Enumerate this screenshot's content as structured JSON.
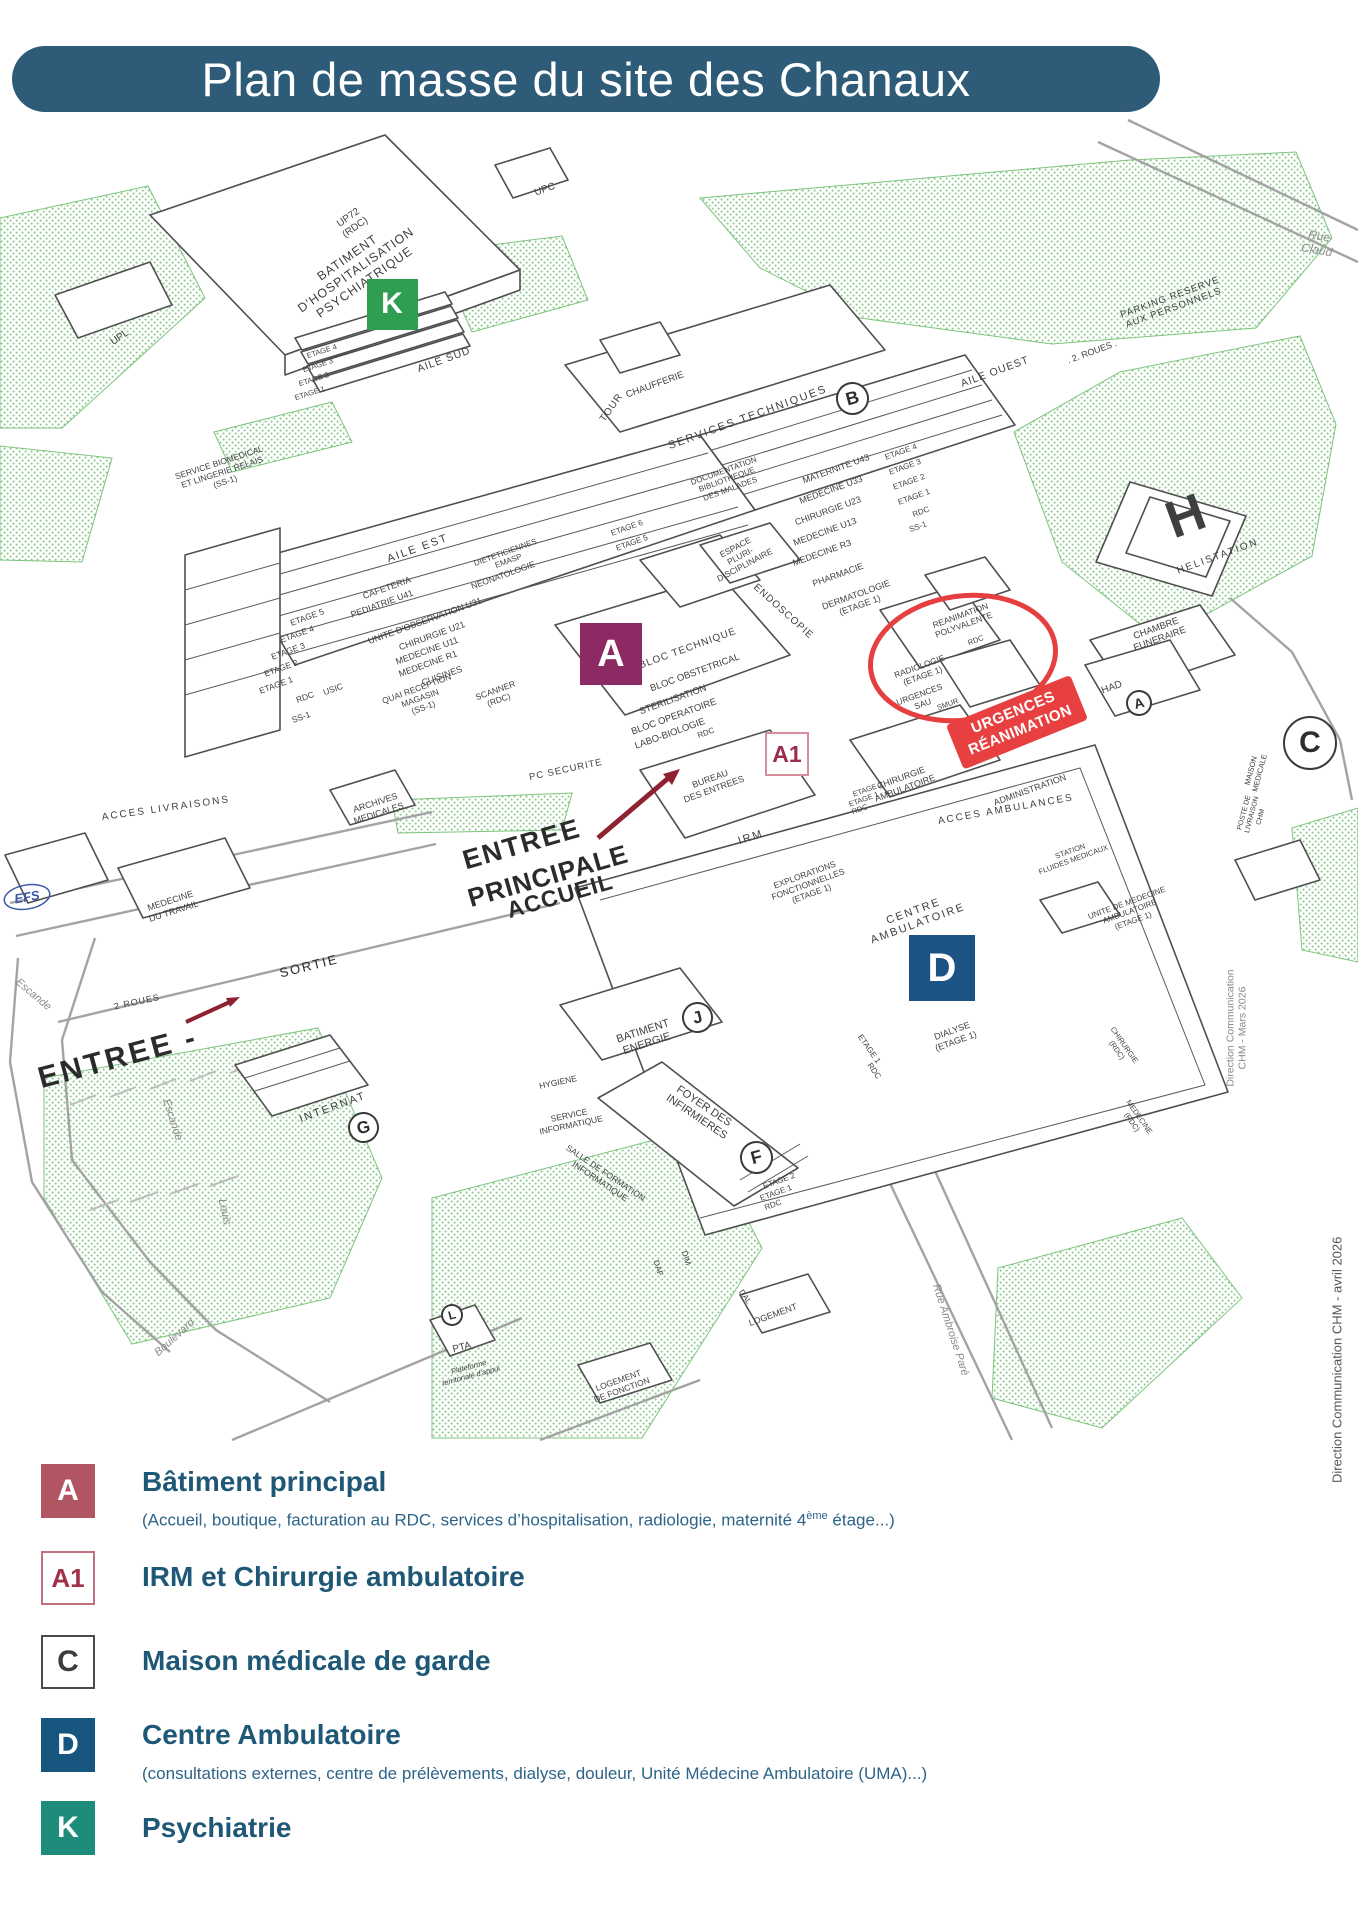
{
  "header": {
    "title": "Plan de masse du site des Chanaux",
    "bg": "#2e5b77"
  },
  "credits": {
    "page_credit": "Direction Communication CHM - avril 2026",
    "map_credit": "Direction Communication CHM - Mars 2026"
  },
  "map": {
    "accent_red": "#e63f3f",
    "arrow_red": "#8e2230",
    "badge": {
      "lines": "URGENCES\nRÉANIMATION",
      "x": 1017,
      "y": 722,
      "r": -22,
      "bg": "#e84040"
    },
    "markers": [
      {
        "shape": "square",
        "label": "K",
        "x": 392,
        "y": 304,
        "size": 51,
        "bg": "#2f9e51",
        "color": "#ffffff",
        "fs": 30
      },
      {
        "shape": "square",
        "label": "A",
        "x": 611,
        "y": 654,
        "size": 62,
        "bg": "#8e2a63",
        "color": "#ffffff",
        "fs": 38
      },
      {
        "shape": "square",
        "label": "A1",
        "x": 787,
        "y": 754,
        "size": 44,
        "bg": "#ffffff",
        "color": "#9c2d4a",
        "border": "#d4919c",
        "fs": 23
      },
      {
        "shape": "square",
        "label": "D",
        "x": 942,
        "y": 968,
        "size": 66,
        "bg": "#1d5285",
        "color": "#ffffff",
        "fs": 40
      },
      {
        "shape": "circle",
        "label": "B",
        "x": 852,
        "y": 398,
        "size": 33,
        "fs": 18,
        "r": -15
      },
      {
        "shape": "circle",
        "label": "J",
        "x": 697,
        "y": 1017,
        "size": 31,
        "fs": 17,
        "r": -15
      },
      {
        "shape": "circle",
        "label": "F",
        "x": 756,
        "y": 1157,
        "size": 33,
        "fs": 18,
        "r": -15
      },
      {
        "shape": "circle",
        "label": "G",
        "x": 363,
        "y": 1127,
        "size": 31,
        "fs": 17,
        "r": -15
      },
      {
        "shape": "circle",
        "label": "A",
        "x": 1139,
        "y": 703,
        "size": 26,
        "fs": 14,
        "r": -15
      },
      {
        "shape": "circle",
        "label": "L",
        "x": 452,
        "y": 1315,
        "size": 22,
        "fs": 12,
        "r": -15
      },
      {
        "shape": "circle",
        "label": "C",
        "x": 1310,
        "y": 743,
        "size": 54,
        "fs": 30,
        "r": 0
      }
    ],
    "labels": [
      {
        "t": "UPC",
        "x": 545,
        "y": 190,
        "r": -20,
        "s": 10
      },
      {
        "t": "UP72\n(RDC)",
        "x": 352,
        "y": 223,
        "r": -35,
        "s": 10
      },
      {
        "t": "UPL",
        "x": 120,
        "y": 338,
        "r": -35,
        "s": 10
      },
      {
        "t": "BATIMENT\nD'HOSPITALISATION\nPSYCHIATRIQUE",
        "x": 356,
        "y": 270,
        "r": -35,
        "s": 12.5,
        "ls": 1
      },
      {
        "t": "Rue Claud",
        "x": 1318,
        "y": 243,
        "r": 10,
        "s": 12,
        "c": "#8a8a8a",
        "i": 1
      },
      {
        "t": "PARKING RESERVE\nAUX PERSONNELS",
        "x": 1172,
        "y": 303,
        "r": -20,
        "s": 9.5,
        "ls": 1
      },
      {
        "t": ". 2. ROUES .",
        "x": 1092,
        "y": 352,
        "r": -20,
        "s": 9
      },
      {
        "t": "CHAUFFERIE",
        "x": 655,
        "y": 385,
        "r": -20,
        "s": 9.5
      },
      {
        "t": "SERVICES TECHNIQUES",
        "x": 748,
        "y": 418,
        "r": -20,
        "s": 11,
        "ls": 2
      },
      {
        "t": "AILE OUEST",
        "x": 995,
        "y": 372,
        "r": -20,
        "s": 10.5,
        "ls": 1
      },
      {
        "t": "AILE SUD",
        "x": 444,
        "y": 360,
        "r": -20,
        "s": 10.5,
        "ls": 1
      },
      {
        "t": "TOUR",
        "x": 612,
        "y": 408,
        "r": -55,
        "s": 10,
        "ls": 1
      },
      {
        "t": "ETAGE 4",
        "x": 322,
        "y": 352,
        "r": -18,
        "s": 7.5
      },
      {
        "t": "ETAGE 3",
        "x": 318,
        "y": 366,
        "r": -18,
        "s": 7.5
      },
      {
        "t": "ETAGE 2",
        "x": 314,
        "y": 380,
        "r": -18,
        "s": 7.5
      },
      {
        "t": "ETAGE 1",
        "x": 310,
        "y": 394,
        "r": -18,
        "s": 7.5
      },
      {
        "t": "SERVICE BIOMEDICAL\nET LINGERIE RELAIS\n(SS-1)",
        "x": 222,
        "y": 472,
        "r": -18,
        "s": 8.5
      },
      {
        "t": "DOCUMENTATION\nBIBLIOTHEQUE\nDES MALADES",
        "x": 727,
        "y": 480,
        "r": -20,
        "s": 8
      },
      {
        "t": "MATERNITE U43",
        "x": 836,
        "y": 469,
        "r": -20,
        "s": 9
      },
      {
        "t": "MEDECINE U33",
        "x": 831,
        "y": 490,
        "r": -20,
        "s": 9
      },
      {
        "t": "CHIRURGIE U23",
        "x": 828,
        "y": 511,
        "r": -20,
        "s": 9
      },
      {
        "t": "MEDECINE U13",
        "x": 825,
        "y": 532,
        "r": -20,
        "s": 9
      },
      {
        "t": "MEDECINE R3",
        "x": 822,
        "y": 553,
        "r": -20,
        "s": 9
      },
      {
        "t": "PHARMACIE",
        "x": 838,
        "y": 575,
        "r": -20,
        "s": 9
      },
      {
        "t": "DERMATOLOGIE\n(ETAGE 1)",
        "x": 858,
        "y": 600,
        "r": -20,
        "s": 9
      },
      {
        "t": "ETAGE 4",
        "x": 901,
        "y": 452,
        "r": -20,
        "s": 8
      },
      {
        "t": "ETAGE 3",
        "x": 905,
        "y": 467,
        "r": -20,
        "s": 8
      },
      {
        "t": "ETAGE 2",
        "x": 909,
        "y": 482,
        "r": -20,
        "s": 8
      },
      {
        "t": "ETAGE 1",
        "x": 914,
        "y": 497,
        "r": -20,
        "s": 8
      },
      {
        "t": "RDC",
        "x": 921,
        "y": 512,
        "r": -20,
        "s": 8
      },
      {
        "t": "SS-1",
        "x": 918,
        "y": 527,
        "r": -20,
        "s": 8
      },
      {
        "t": "ESPACE\nPLURI-\nDISCIPLINAIRE",
        "x": 740,
        "y": 556,
        "r": -28,
        "s": 8.5
      },
      {
        "t": "ENDOSCOPIE",
        "x": 783,
        "y": 612,
        "r": 42,
        "s": 10,
        "ls": 1
      },
      {
        "t": "AILE EST",
        "x": 418,
        "y": 549,
        "r": -20,
        "s": 11,
        "ls": 2
      },
      {
        "t": "ETAGE 5",
        "x": 307,
        "y": 617,
        "r": -20,
        "s": 8.5
      },
      {
        "t": "ETAGE 4",
        "x": 297,
        "y": 634,
        "r": -20,
        "s": 8.5
      },
      {
        "t": "ETAGE 3",
        "x": 288,
        "y": 651,
        "r": -20,
        "s": 8.5
      },
      {
        "t": "ETAGE 2",
        "x": 281,
        "y": 668,
        "r": -20,
        "s": 8.5
      },
      {
        "t": "ETAGE 1",
        "x": 276,
        "y": 685,
        "r": -20,
        "s": 8.5
      },
      {
        "t": "RDC",
        "x": 305,
        "y": 697,
        "r": -20,
        "s": 8.5
      },
      {
        "t": "USIC",
        "x": 333,
        "y": 689,
        "r": -20,
        "s": 8.5
      },
      {
        "t": "SS-1",
        "x": 301,
        "y": 717,
        "r": -20,
        "s": 8.5
      },
      {
        "t": "CAFETERIA",
        "x": 387,
        "y": 588,
        "r": -20,
        "s": 9
      },
      {
        "t": "PEDIATRIE U41",
        "x": 382,
        "y": 604,
        "r": -20,
        "s": 9
      },
      {
        "t": "UNITE D'OBSERVATION U31",
        "x": 425,
        "y": 621,
        "r": -20,
        "s": 9
      },
      {
        "t": "CHIRURGIE U21",
        "x": 432,
        "y": 636,
        "r": -20,
        "s": 9
      },
      {
        "t": "MEDECINE U11",
        "x": 427,
        "y": 651,
        "r": -20,
        "s": 9
      },
      {
        "t": "MEDECINE R1",
        "x": 428,
        "y": 664,
        "r": -20,
        "s": 9
      },
      {
        "t": "CUISINES",
        "x": 442,
        "y": 676,
        "r": -20,
        "s": 9
      },
      {
        "t": "DIETETICIENNES\nEMASP",
        "x": 507,
        "y": 557,
        "r": -20,
        "s": 8
      },
      {
        "t": "NEONATOLOGIE",
        "x": 503,
        "y": 575,
        "r": -20,
        "s": 8.5
      },
      {
        "t": "QUAI RECEPTION\nMAGASIN\n(SS-1)",
        "x": 420,
        "y": 698,
        "r": -20,
        "s": 8.5
      },
      {
        "t": "SCANNER\n(RDC)",
        "x": 497,
        "y": 695,
        "r": -20,
        "s": 8.5
      },
      {
        "t": "ETAGE 6",
        "x": 627,
        "y": 528,
        "r": -20,
        "s": 8
      },
      {
        "t": "ETAGE 5",
        "x": 632,
        "y": 543,
        "r": -20,
        "s": 8
      },
      {
        "t": "BLOC TECHNIQUE",
        "x": 688,
        "y": 649,
        "r": -20,
        "s": 10,
        "ls": 1
      },
      {
        "t": "BLOC OBSTETRICAL",
        "x": 695,
        "y": 673,
        "r": -20,
        "s": 9.5
      },
      {
        "t": "STERILISATION",
        "x": 673,
        "y": 700,
        "r": -20,
        "s": 9.5
      },
      {
        "t": "BLOC OPERATOIRE",
        "x": 674,
        "y": 717,
        "r": -20,
        "s": 9.5
      },
      {
        "t": "LABO-BIOLOGIE",
        "x": 670,
        "y": 734,
        "r": -20,
        "s": 9.5
      },
      {
        "t": "RDC",
        "x": 706,
        "y": 733,
        "r": -20,
        "s": 8
      },
      {
        "t": "PC SECURITE",
        "x": 566,
        "y": 770,
        "r": -12,
        "s": 9.5,
        "ls": 1
      },
      {
        "t": "BUREAU\nDES ENTREES",
        "x": 712,
        "y": 784,
        "r": -20,
        "s": 9
      },
      {
        "t": "REANIMATION\nPOLYVALENTE",
        "x": 962,
        "y": 620,
        "r": -20,
        "s": 8.5
      },
      {
        "t": "RDC",
        "x": 976,
        "y": 641,
        "r": -20,
        "s": 7.5
      },
      {
        "t": "RADIOLOGIE\n(ETAGE 1)",
        "x": 921,
        "y": 671,
        "r": -20,
        "s": 8.5
      },
      {
        "t": "URGENCES\nSAU",
        "x": 921,
        "y": 699,
        "r": -20,
        "s": 8.5
      },
      {
        "t": "SMUR",
        "x": 948,
        "y": 705,
        "r": -20,
        "s": 7.5
      },
      {
        "t": "HAD",
        "x": 1112,
        "y": 688,
        "r": -20,
        "s": 10
      },
      {
        "t": "CHAMBRE\nFUNERAIRE",
        "x": 1158,
        "y": 634,
        "r": -20,
        "s": 9.5
      },
      {
        "t": "H",
        "x": 1186,
        "y": 517,
        "r": -20,
        "s": 52,
        "b": 1
      },
      {
        "t": "HELISTATION",
        "x": 1218,
        "y": 557,
        "r": -20,
        "s": 10,
        "ls": 2
      },
      {
        "t": "MAISON\nMEDICALE",
        "x": 1256,
        "y": 772,
        "r": -75,
        "s": 7.5
      },
      {
        "t": "POSTE DE\nLIVRAISON\nCHM",
        "x": 1253,
        "y": 815,
        "r": -75,
        "s": 7
      },
      {
        "t": "ADMINISTRATION",
        "x": 1030,
        "y": 790,
        "r": -20,
        "s": 9
      },
      {
        "t": "ACCES AMBULANCES",
        "x": 1006,
        "y": 810,
        "r": -10,
        "s": 10,
        "ls": 2
      },
      {
        "t": "CHIRURGIE\nAMBULATOIRE",
        "x": 903,
        "y": 783,
        "r": -20,
        "s": 9
      },
      {
        "t": "ETAGE 2",
        "x": 868,
        "y": 790,
        "r": -20,
        "s": 7.5
      },
      {
        "t": "ETAGE 1",
        "x": 864,
        "y": 800,
        "r": -20,
        "s": 7.5
      },
      {
        "t": "RDC",
        "x": 860,
        "y": 810,
        "r": -20,
        "s": 7.5
      },
      {
        "t": "IRM",
        "x": 751,
        "y": 838,
        "r": -18,
        "s": 11,
        "ls": 2
      },
      {
        "t": "STATION\nFLUIDES MEDICAUX",
        "x": 1072,
        "y": 856,
        "r": -20,
        "s": 7.5
      },
      {
        "t": "UNITE DE MEDECINE\nAMBULATOIRE\n(ETAGE 1)",
        "x": 1130,
        "y": 912,
        "r": -20,
        "s": 8
      },
      {
        "t": "EXPLORATIONS\nFONCTIONNELLES\n(ETAGE 1)",
        "x": 808,
        "y": 884,
        "r": -20,
        "s": 8.5
      },
      {
        "t": "CENTRE\nAMBULATOIRE",
        "x": 916,
        "y": 918,
        "r": -20,
        "s": 11,
        "ls": 2
      },
      {
        "t": "DIALYSE\n(ETAGE 1)",
        "x": 954,
        "y": 1036,
        "r": -20,
        "s": 9
      },
      {
        "t": "ETAGE 1",
        "x": 869,
        "y": 1049,
        "r": 55,
        "s": 8
      },
      {
        "t": "RDC",
        "x": 874,
        "y": 1071,
        "r": 55,
        "s": 8
      },
      {
        "t": "CHIRURGIE\n(RDC)",
        "x": 1120,
        "y": 1048,
        "r": 55,
        "s": 7.5
      },
      {
        "t": "MEDECINE\n(RDC)",
        "x": 1135,
        "y": 1120,
        "r": 55,
        "s": 7.5
      },
      {
        "t": "ACCES LIVRAISONS",
        "x": 166,
        "y": 809,
        "r": -8,
        "s": 10,
        "ls": 2
      },
      {
        "t": "ARCHIVES\nMEDICALES",
        "x": 377,
        "y": 808,
        "r": -18,
        "s": 9
      },
      {
        "t": "EFS",
        "x": 27,
        "y": 897,
        "r": -10,
        "s": 13,
        "b": 1,
        "i": 1,
        "c": "#3a57a8"
      },
      {
        "t": "MEDECINE\nDU TRAVAIL",
        "x": 172,
        "y": 906,
        "r": -18,
        "s": 9
      },
      {
        "t": "ENTREE",
        "x": 522,
        "y": 845,
        "r": -16,
        "s": 27,
        "b": 1,
        "c": "#2b2b2b",
        "ls": 2
      },
      {
        "t": "PRINCIPALE",
        "x": 548,
        "y": 876,
        "r": -16,
        "s": 26,
        "b": 1,
        "c": "#2b2b2b",
        "ls": 1
      },
      {
        "t": "ACCUEIL",
        "x": 560,
        "y": 896,
        "r": -16,
        "s": 23,
        "b": 1,
        "c": "#2b2b2b",
        "ls": 1
      },
      {
        "t": "SORTIE",
        "x": 309,
        "y": 966,
        "r": -14,
        "s": 13,
        "ls": 2,
        "c": "#2b2b2b"
      },
      {
        "t": "2 ROUES",
        "x": 137,
        "y": 1002,
        "r": -12,
        "s": 9,
        "ls": 1
      },
      {
        "t": "ENTREE -",
        "x": 118,
        "y": 1058,
        "r": -15,
        "s": 30,
        "b": 1,
        "c": "#2b2b2b",
        "ls": 3
      },
      {
        "t": "Escande",
        "x": 33,
        "y": 995,
        "r": 40,
        "s": 11,
        "c": "#8a8a8a",
        "i": 1
      },
      {
        "t": "Escande",
        "x": 172,
        "y": 1120,
        "r": 72,
        "s": 11,
        "c": "#8a8a8a",
        "i": 1
      },
      {
        "t": "Louis",
        "x": 224,
        "y": 1212,
        "r": 78,
        "s": 11,
        "c": "#8a8a8a",
        "i": 1
      },
      {
        "t": "Boulevard",
        "x": 175,
        "y": 1338,
        "r": -42,
        "s": 11,
        "c": "#8a8a8a",
        "i": 1
      },
      {
        "t": "INTERNAT",
        "x": 333,
        "y": 1108,
        "r": -20,
        "s": 11,
        "ls": 2
      },
      {
        "t": "BATIMENT\nENERGIE",
        "x": 645,
        "y": 1038,
        "r": -18,
        "s": 11
      },
      {
        "t": "FOYER DES\nINFIRMIERES",
        "x": 700,
        "y": 1112,
        "r": 34,
        "s": 11
      },
      {
        "t": "ETAGE 2",
        "x": 779,
        "y": 1181,
        "r": -20,
        "s": 8
      },
      {
        "t": "ETAGE 1",
        "x": 776,
        "y": 1193,
        "r": -20,
        "s": 8
      },
      {
        "t": "RDC",
        "x": 773,
        "y": 1205,
        "r": -20,
        "s": 8
      },
      {
        "t": "HYGIENE",
        "x": 558,
        "y": 1082,
        "r": -12,
        "s": 8.5
      },
      {
        "t": "SERVICE\nINFORMATIQUE",
        "x": 570,
        "y": 1120,
        "r": -12,
        "s": 8.5
      },
      {
        "t": "SALLE DE FORMATION\nINFORMATIQUE",
        "x": 603,
        "y": 1177,
        "r": 34,
        "s": 8.5
      },
      {
        "t": "DAF",
        "x": 658,
        "y": 1268,
        "r": 72,
        "s": 8
      },
      {
        "t": "DIM",
        "x": 686,
        "y": 1258,
        "r": 72,
        "s": 8
      },
      {
        "t": "DAL",
        "x": 745,
        "y": 1297,
        "r": 55,
        "s": 8
      },
      {
        "t": "PTA",
        "x": 462,
        "y": 1348,
        "r": -15,
        "s": 10
      },
      {
        "t": "Plateforme\nterritoriale d'appui",
        "x": 470,
        "y": 1372,
        "r": -15,
        "s": 7.5,
        "i": 1
      },
      {
        "t": "LOGEMENT",
        "x": 773,
        "y": 1315,
        "r": -20,
        "s": 9
      },
      {
        "t": "LOGEMENT\nDE FONCTION",
        "x": 620,
        "y": 1385,
        "r": -20,
        "s": 8.5
      },
      {
        "t": "Rue Ambroise Paré",
        "x": 950,
        "y": 1330,
        "r": 72,
        "s": 11,
        "c": "#8a8a8a",
        "i": 1
      },
      {
        "t": "Direction Communication CHM - Mars 2026",
        "x": 1237,
        "y": 1028,
        "r": -90,
        "s": 10.5,
        "c": "#8a8a8a"
      }
    ]
  },
  "legend": {
    "items": [
      {
        "code": "A",
        "bg": "#b25563",
        "color": "#ffffff",
        "box_top": 1464,
        "title_top": 1466,
        "title": "Bâtiment principal",
        "subtitle_top": 1510,
        "subtitle": [
          {
            "t": "(Accueil, boutique, facturation au RDC, services d’hospitalisation, radiologie, maternité 4"
          },
          {
            "t": "ème",
            "sup": true
          },
          {
            "t": " étage...)"
          }
        ]
      },
      {
        "code": "A1",
        "bg": "#ffffff",
        "color": "#a03048",
        "border": "#c4707f",
        "box_top": 1551,
        "title_top": 1561,
        "title": "IRM et Chirurgie ambulatoire"
      },
      {
        "code": "C",
        "bg": "#ffffff",
        "color": "#3d3d3d",
        "border": "#4a4a4a",
        "box_top": 1635,
        "title_top": 1645,
        "title": "Maison médicale de garde"
      },
      {
        "code": "D",
        "bg": "#17567f",
        "color": "#ffffff",
        "box_top": 1718,
        "title_top": 1719,
        "title": "Centre Ambulatoire",
        "subtitle_top": 1764,
        "subtitle": [
          {
            "t": "(consultations externes, centre de prélèvements, dialyse, douleur, Unité Médecine Ambulatoire (UMA)...)"
          }
        ]
      },
      {
        "code": "K",
        "bg": "#1e8c7a",
        "color": "#ffffff",
        "box_top": 1801,
        "title_top": 1812,
        "title": "Psychiatrie"
      }
    ]
  }
}
